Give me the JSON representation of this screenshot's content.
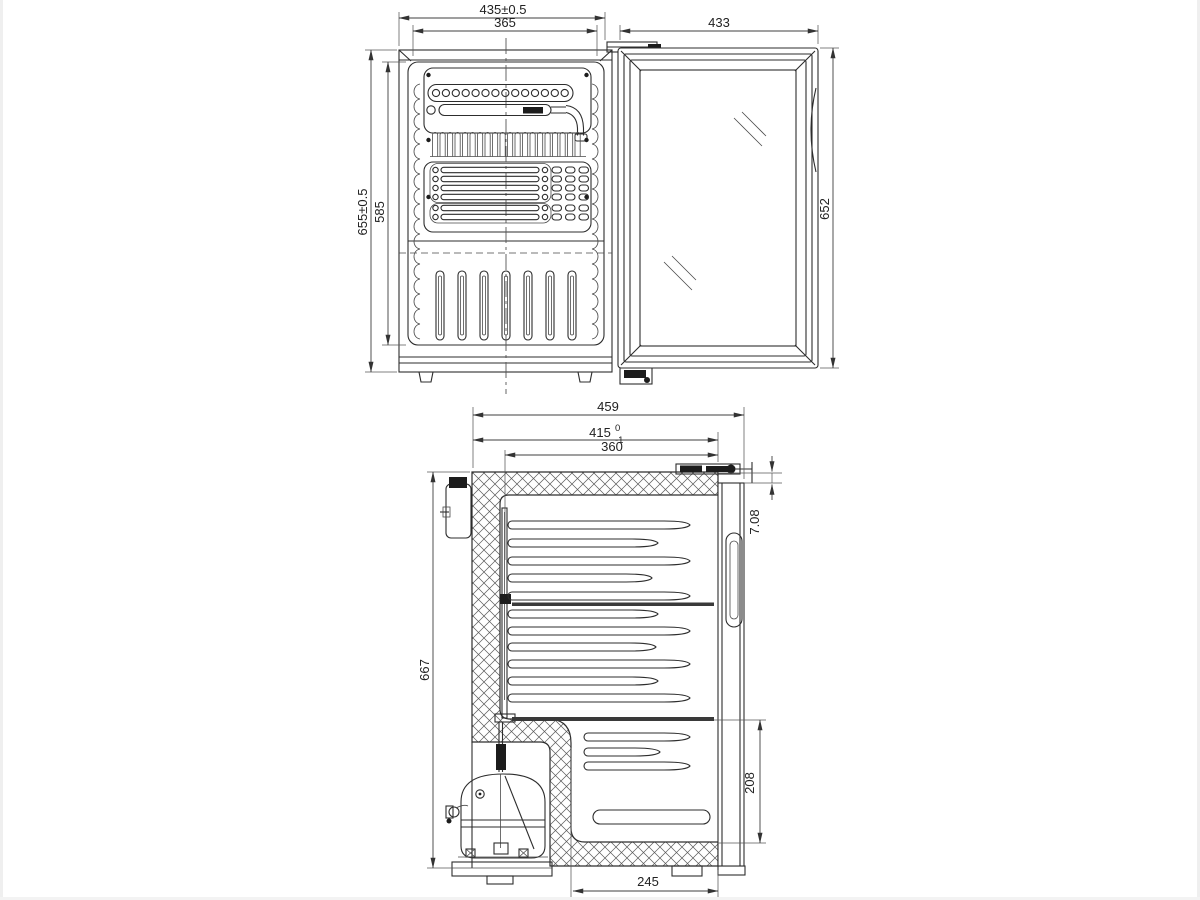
{
  "views": {
    "rear": {
      "dims": {
        "overall_width": "435±0.5",
        "panel_width": "365",
        "door_width": "433",
        "overall_height": "655±0.5",
        "panel_height": "585",
        "door_height": "652"
      }
    },
    "side": {
      "dims": {
        "overall_depth": "459",
        "body_depth": "415",
        "body_depth_tol_upper": "0",
        "body_depth_tol_lower": "-1",
        "inner_depth": "360",
        "overall_height": "667",
        "door_top_gap": "7.08",
        "lower_compartment_height": "208",
        "base_recess_depth": "245"
      }
    }
  }
}
